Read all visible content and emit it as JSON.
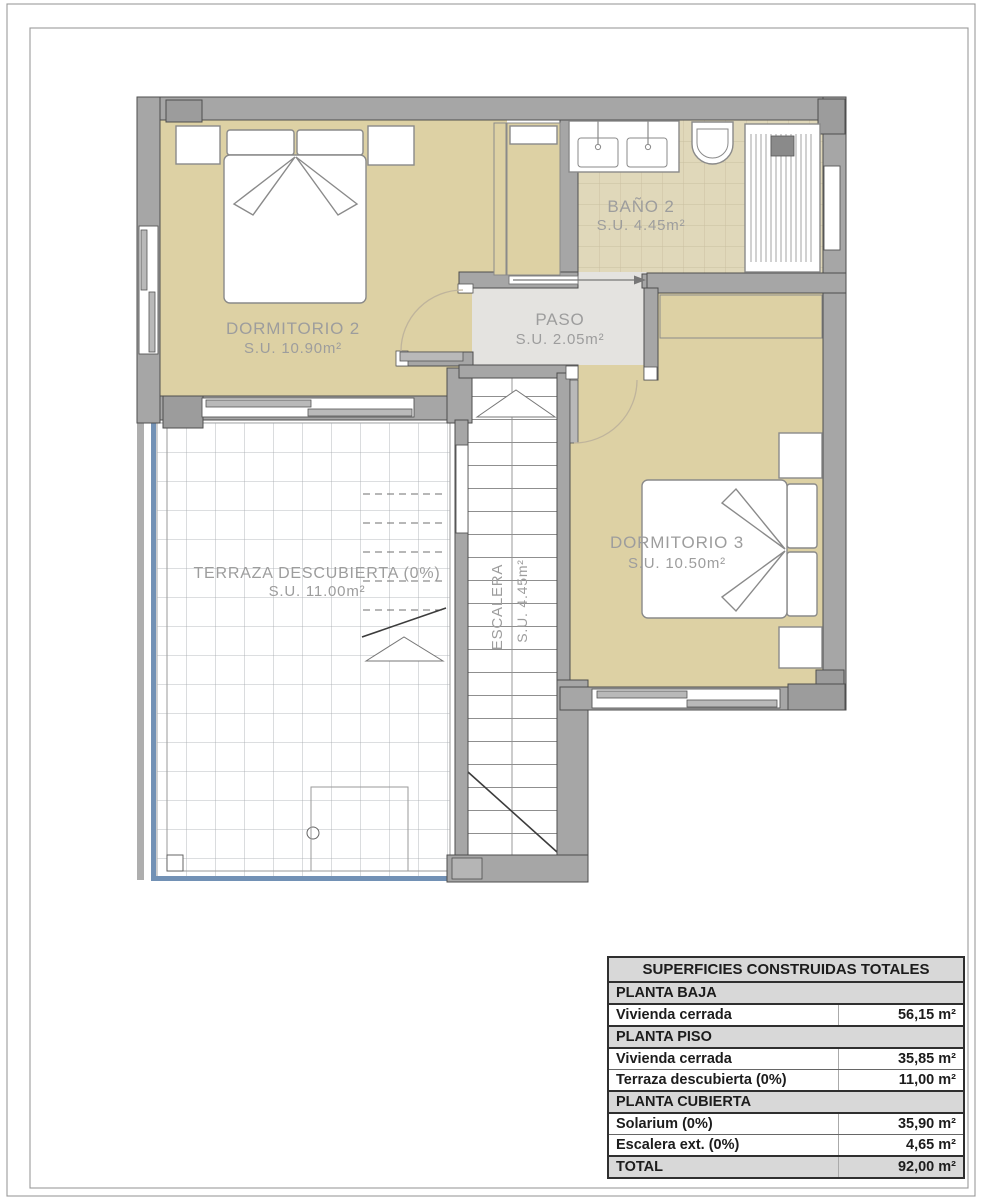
{
  "plan": {
    "rooms": {
      "dormitorio2": {
        "name": "DORMITORIO 2",
        "area": "S.U. 10.90m²"
      },
      "bano2": {
        "name": "BAÑO 2",
        "area": "S.U. 4.45m²"
      },
      "paso": {
        "name": "PASO",
        "area": "S.U. 2.05m²"
      },
      "dormitorio3": {
        "name": "DORMITORIO 3",
        "area": "S.U. 10.50m²"
      },
      "terraza": {
        "name": "TERRAZA DESCUBIERTA (0%)",
        "area": "S.U. 11.00m²"
      },
      "escalera": {
        "name": "ESCALERA",
        "area": "S.U. 4.45m²"
      }
    }
  },
  "table": {
    "title": "SUPERFICIES CONSTRUIDAS TOTALES",
    "rows": [
      {
        "label": "PLANTA BAJA",
        "value": "",
        "type": "section"
      },
      {
        "label": "Vivienda cerrada",
        "value": "56,15 m²",
        "type": "data"
      },
      {
        "label": "PLANTA PISO",
        "value": "",
        "type": "section"
      },
      {
        "label": "Vivienda cerrada",
        "value": "35,85 m²",
        "type": "data"
      },
      {
        "label": "Terraza descubierta (0%)",
        "value": "11,00 m²",
        "type": "data"
      },
      {
        "label": "PLANTA CUBIERTA",
        "value": "",
        "type": "section"
      },
      {
        "label": "Solarium (0%)",
        "value": "35,90 m²",
        "type": "data"
      },
      {
        "label": "Escalera ext. (0%)",
        "value": "4,65 m²",
        "type": "data"
      },
      {
        "label": "TOTAL",
        "value": "92,00 m²",
        "type": "total"
      }
    ]
  },
  "colors": {
    "wall": "#a6a6a6",
    "wall_stroke": "#4e4e4e",
    "pillar": "#9c9c9c",
    "floor": "#ddd1a4",
    "tile_bg": "#e0d8ba",
    "tile_line": "#c9bfa0",
    "paso_floor": "#e4e3e0",
    "grid_line": "#a4a8ac",
    "balustrade": "#7291b5",
    "label": "#9d9d9d",
    "furniture_stroke": "#8a8a8a",
    "table_header_bg": "#d8d8d8",
    "table_border": "#2f2f2f"
  }
}
